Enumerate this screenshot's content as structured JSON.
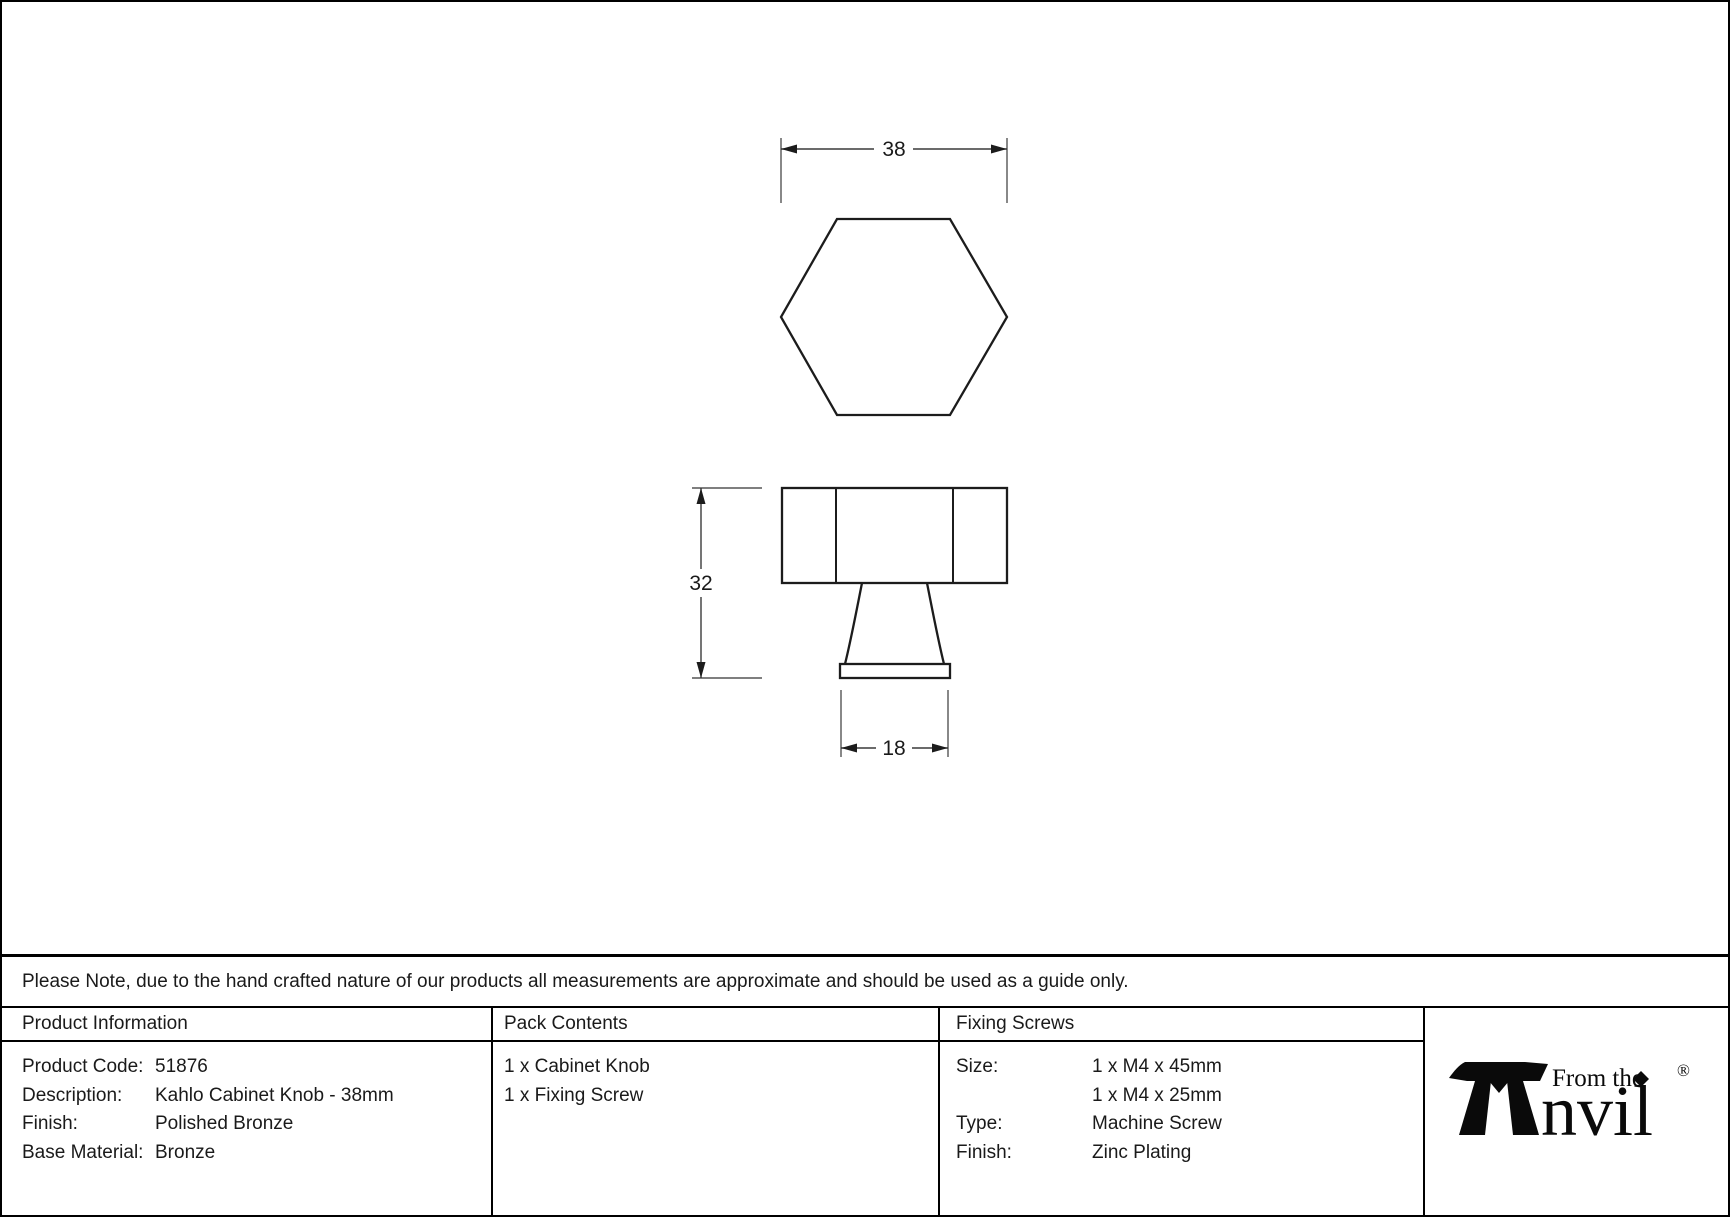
{
  "colors": {
    "background": "#ffffff",
    "border": "#000000",
    "object_line": "#1c1c1c",
    "dimension_line": "#555555",
    "text": "#1a1a1a",
    "logo_ink": "#0a0a0a"
  },
  "drawing": {
    "view_top": "hexagonal-knob-top-view",
    "view_side": "knob-side-view",
    "dim_width_mm": "38",
    "dim_height_mm": "32",
    "dim_base_mm": "18"
  },
  "note": {
    "text": "Please Note, due to the hand crafted nature of our products all measurements are approximate and should be used as a guide only."
  },
  "table": {
    "product_information": {
      "header": "Product Information",
      "rows": [
        {
          "label": "Product Code:",
          "value": "51876"
        },
        {
          "label": "Description:",
          "value": "Kahlo Cabinet Knob - 38mm"
        },
        {
          "label": "Finish:",
          "value": "Polished Bronze"
        },
        {
          "label": "Base Material:",
          "value": "Bronze"
        }
      ]
    },
    "pack_contents": {
      "header": "Pack Contents",
      "items": [
        "1 x Cabinet Knob",
        "1 x Fixing Screw"
      ]
    },
    "fixing_screws": {
      "header": "Fixing Screws",
      "rows": [
        {
          "label": "Size:",
          "value": "1 x M4 x 45mm"
        },
        {
          "label": "",
          "value": "1 x M4 x 25mm"
        },
        {
          "label": "Type:",
          "value": "Machine Screw"
        },
        {
          "label": "Finish:",
          "value": "Zinc Plating"
        }
      ]
    }
  },
  "logo": {
    "tagline": "From the",
    "wordmark": "nvil",
    "registered": "®"
  }
}
